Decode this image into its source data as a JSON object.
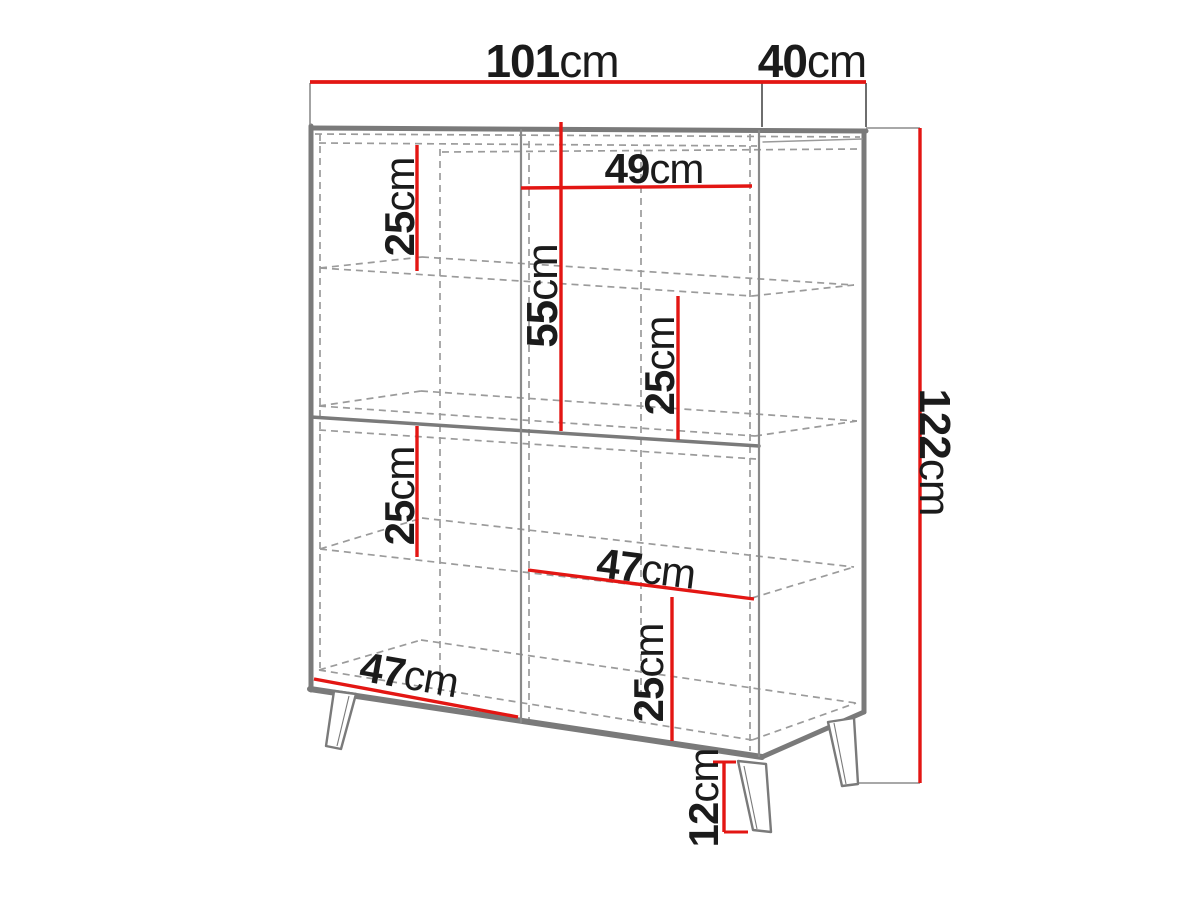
{
  "meta": {
    "type": "furniture-dimension-diagram",
    "subject": "sideboard cabinet with shelves and angled legs",
    "measurement_unit": "cm"
  },
  "colors": {
    "dimension_red": "#e31613",
    "outline_gray": "#7a7a7a",
    "hidden_line_gray": "#9b9b9b",
    "text_black": "#1b1b1b",
    "background": "#ffffff"
  },
  "dimensions": {
    "overall_width": {
      "value": "101",
      "unit": "cm"
    },
    "overall_depth": {
      "value": "40",
      "unit": "cm"
    },
    "overall_height": {
      "value": "122",
      "unit": "cm"
    },
    "upper_inner_width": {
      "value": "49",
      "unit": "cm"
    },
    "upper_left_compartment_height": {
      "value": "25",
      "unit": "cm"
    },
    "upper_section_height": {
      "value": "55",
      "unit": "cm"
    },
    "upper_right_compartment_height": {
      "value": "25",
      "unit": "cm"
    },
    "lower_left_compartment_height": {
      "value": "25",
      "unit": "cm"
    },
    "lower_inner_width": {
      "value": "47",
      "unit": "cm"
    },
    "lower_right_compartment_height": {
      "value": "25",
      "unit": "cm"
    },
    "bottom_inner_width": {
      "value": "47",
      "unit": "cm"
    },
    "leg_height": {
      "value": "12",
      "unit": "cm"
    }
  }
}
